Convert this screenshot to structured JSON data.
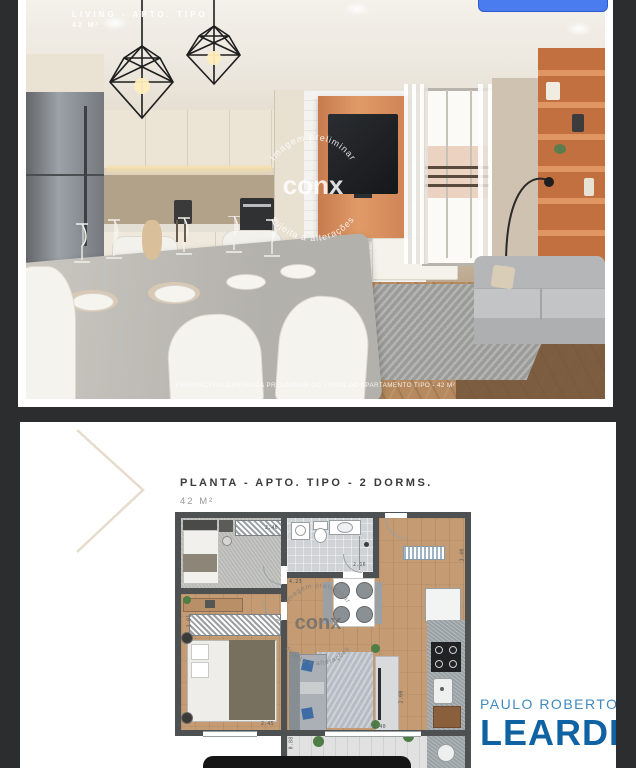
{
  "colors": {
    "page_background": "#2b2d2e",
    "gallery_button_blue": "#4a7cf0",
    "logo_light_blue": "#3f8ac0",
    "logo_dark_blue": "#1063a2",
    "plan_wall_gray": "#4e5152",
    "tv_panel_orange": "#d98a5c"
  },
  "photo_card": {
    "overlay_title": "LIVING - APTO. TIPO",
    "overlay_area": "42 M²",
    "caption": "PERSPECTIVA ILUSTRADA PRELIMINAR DO LIVING DO APARTAMENTO TIPO - 42 M²",
    "watermark": {
      "arc_top": "Imagem preliminar",
      "brand": "conx",
      "arc_bottom": "sujeita a alterações"
    }
  },
  "plan_card": {
    "title": "PLANTA - APTO. TIPO - 2 DORMS.",
    "area": "42 M²",
    "watermark": {
      "arc_top": "Imagem preliminar",
      "brand": "conx",
      "arc_bottom": "sujeita a alterações"
    },
    "dimensions": {
      "dorm1_wardrobe": "2.40",
      "hall_width": "1.18",
      "hall_length": "4.23",
      "bath_width": "2.16",
      "living_depth": "3.40",
      "dorm2_depth": "3.01",
      "dorm2_width": "2.45",
      "kitchen_depth": "2.00",
      "terrace_width": "1.40",
      "terrace_depth": "0.88"
    },
    "logo": {
      "line1": "PAULO ROBERTO",
      "line2": "LEARDI"
    }
  }
}
